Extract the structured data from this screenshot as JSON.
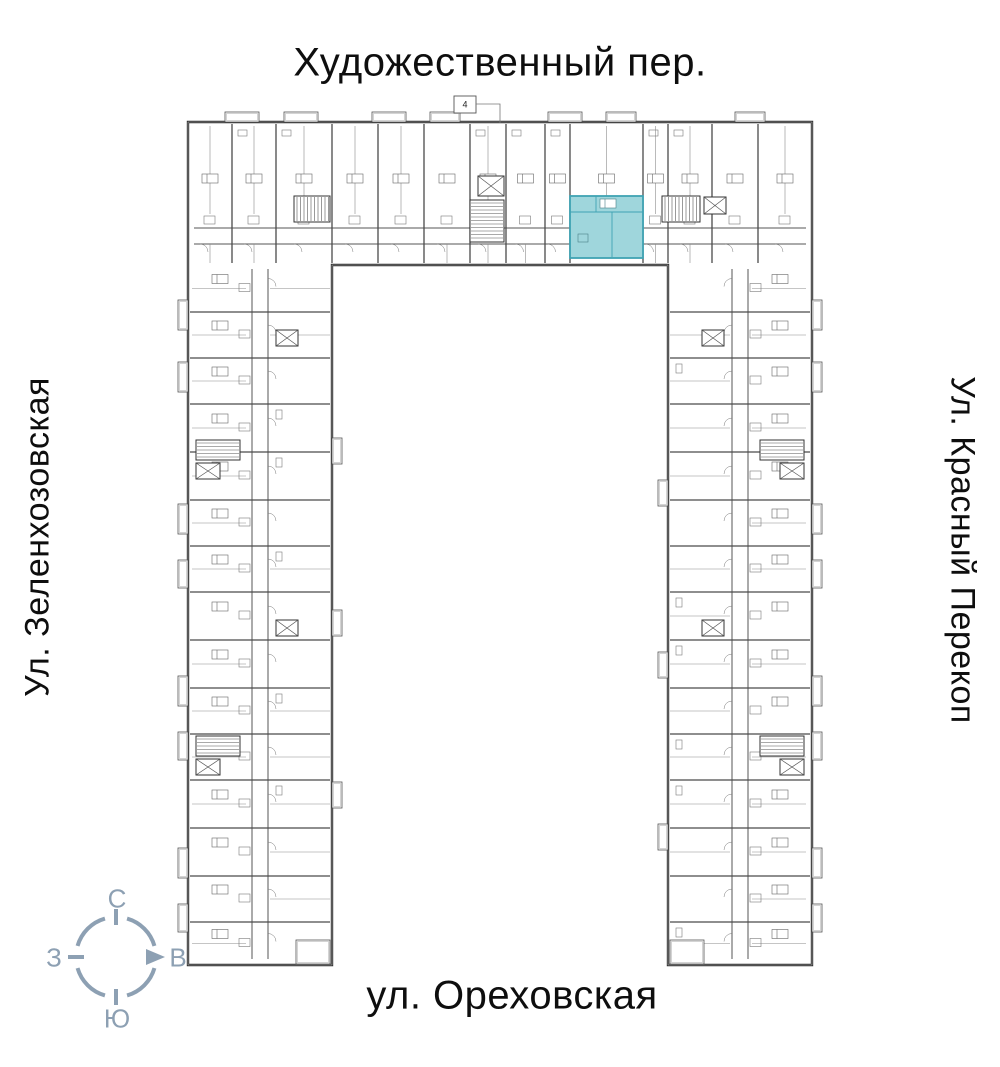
{
  "streets": {
    "top": "Художественный пер.",
    "bottom": "ул. Ореховская",
    "left": "Ул. Зеленхозовская",
    "right": "Ул. Красный Перекоп"
  },
  "compass": {
    "n": "С",
    "s": "Ю",
    "w": "З",
    "e": "В",
    "color": "#8da0b3",
    "center_x": 116,
    "center_y": 957,
    "radius": 40
  },
  "entrance_marker": "4",
  "highlight": {
    "fill": "#9fd6dc",
    "stroke": "#3fa3b3",
    "x": 570,
    "y": 196,
    "w": 73,
    "h": 62
  },
  "plan": {
    "wall_color": "#2c2c2c",
    "partition_color": "#4a4a4a",
    "minor_color": "#8c8c8c",
    "fixture_color": "#7a7a7a",
    "outline": "M 188,122 H 812 V 965 H 668 V 265 H 332 V 965 H 188 Z",
    "wings": [
      {
        "name": "top",
        "dir": "h",
        "x1": 188,
        "y1": 122,
        "x2": 812,
        "y2": 265,
        "corridor": [
          228,
          244
        ],
        "partitions": [
          232,
          276,
          332,
          378,
          424,
          470,
          506,
          545,
          570,
          643,
          668,
          712,
          758
        ]
      },
      {
        "name": "left",
        "dir": "v",
        "x1": 188,
        "y1": 265,
        "x2": 332,
        "y2": 965,
        "corridor": [
          252,
          268
        ],
        "partitions": [
          312,
          358,
          404,
          452,
          500,
          546,
          592,
          640,
          688,
          734,
          780,
          828,
          876,
          922
        ]
      },
      {
        "name": "right",
        "dir": "v",
        "x1": 668,
        "y1": 265,
        "x2": 812,
        "y2": 965,
        "corridor": [
          732,
          748
        ],
        "partitions": [
          312,
          358,
          404,
          452,
          500,
          546,
          592,
          640,
          688,
          734,
          780,
          828,
          876,
          922
        ]
      }
    ],
    "cores": [
      {
        "t": "stair",
        "x": 294,
        "y": 196,
        "w": 36,
        "h": 26,
        "dir": "h"
      },
      {
        "t": "elev",
        "x": 478,
        "y": 176,
        "w": 26,
        "h": 20
      },
      {
        "t": "stair",
        "x": 470,
        "y": 200,
        "w": 34,
        "h": 42,
        "dir": "v"
      },
      {
        "t": "stair",
        "x": 662,
        "y": 196,
        "w": 38,
        "h": 26,
        "dir": "h"
      },
      {
        "t": "elev",
        "x": 704,
        "y": 197,
        "w": 22,
        "h": 17
      },
      {
        "t": "stair",
        "x": 196,
        "y": 440,
        "w": 44,
        "h": 20,
        "dir": "v"
      },
      {
        "t": "elev",
        "x": 196,
        "y": 463,
        "w": 24,
        "h": 16
      },
      {
        "t": "stair",
        "x": 196,
        "y": 736,
        "w": 44,
        "h": 20,
        "dir": "v"
      },
      {
        "t": "elev",
        "x": 196,
        "y": 759,
        "w": 24,
        "h": 16
      },
      {
        "t": "elev",
        "x": 276,
        "y": 330,
        "w": 22,
        "h": 16
      },
      {
        "t": "elev",
        "x": 276,
        "y": 620,
        "w": 22,
        "h": 16
      },
      {
        "t": "stair",
        "x": 760,
        "y": 440,
        "w": 44,
        "h": 20,
        "dir": "v"
      },
      {
        "t": "elev",
        "x": 780,
        "y": 463,
        "w": 24,
        "h": 16
      },
      {
        "t": "stair",
        "x": 760,
        "y": 736,
        "w": 44,
        "h": 20,
        "dir": "v"
      },
      {
        "t": "elev",
        "x": 780,
        "y": 759,
        "w": 24,
        "h": 16
      },
      {
        "t": "elev",
        "x": 702,
        "y": 330,
        "w": 22,
        "h": 16
      },
      {
        "t": "elev",
        "x": 702,
        "y": 620,
        "w": 22,
        "h": 16
      }
    ],
    "balconies": [
      {
        "x": 225,
        "y": 112,
        "w": 34,
        "h": 10
      },
      {
        "x": 284,
        "y": 112,
        "w": 34,
        "h": 10
      },
      {
        "x": 372,
        "y": 112,
        "w": 34,
        "h": 10
      },
      {
        "x": 430,
        "y": 112,
        "w": 30,
        "h": 10
      },
      {
        "x": 548,
        "y": 112,
        "w": 34,
        "h": 10
      },
      {
        "x": 606,
        "y": 112,
        "w": 30,
        "h": 10
      },
      {
        "x": 735,
        "y": 112,
        "w": 30,
        "h": 10
      },
      {
        "x": 178,
        "y": 300,
        "w": 10,
        "h": 30
      },
      {
        "x": 178,
        "y": 362,
        "w": 10,
        "h": 30
      },
      {
        "x": 178,
        "y": 504,
        "w": 10,
        "h": 30
      },
      {
        "x": 178,
        "y": 560,
        "w": 10,
        "h": 28
      },
      {
        "x": 178,
        "y": 676,
        "w": 10,
        "h": 30
      },
      {
        "x": 178,
        "y": 732,
        "w": 10,
        "h": 28
      },
      {
        "x": 178,
        "y": 848,
        "w": 10,
        "h": 30
      },
      {
        "x": 178,
        "y": 904,
        "w": 10,
        "h": 28
      },
      {
        "x": 332,
        "y": 438,
        "w": 10,
        "h": 26
      },
      {
        "x": 332,
        "y": 610,
        "w": 10,
        "h": 26
      },
      {
        "x": 332,
        "y": 782,
        "w": 10,
        "h": 26
      },
      {
        "x": 296,
        "y": 940,
        "w": 34,
        "h": 24
      },
      {
        "x": 812,
        "y": 300,
        "w": 10,
        "h": 30
      },
      {
        "x": 812,
        "y": 362,
        "w": 10,
        "h": 30
      },
      {
        "x": 812,
        "y": 504,
        "w": 10,
        "h": 30
      },
      {
        "x": 812,
        "y": 560,
        "w": 10,
        "h": 28
      },
      {
        "x": 812,
        "y": 676,
        "w": 10,
        "h": 30
      },
      {
        "x": 812,
        "y": 732,
        "w": 10,
        "h": 28
      },
      {
        "x": 812,
        "y": 848,
        "w": 10,
        "h": 30
      },
      {
        "x": 812,
        "y": 904,
        "w": 10,
        "h": 28
      },
      {
        "x": 658,
        "y": 480,
        "w": 10,
        "h": 26
      },
      {
        "x": 658,
        "y": 652,
        "w": 10,
        "h": 26
      },
      {
        "x": 658,
        "y": 824,
        "w": 10,
        "h": 26
      },
      {
        "x": 670,
        "y": 940,
        "w": 34,
        "h": 24
      }
    ],
    "entrance_box": {
      "x": 454,
      "y": 96,
      "w": 22,
      "h": 17,
      "leader": [
        [
          476,
          104
        ],
        [
          500,
          104
        ],
        [
          500,
          123
        ]
      ]
    }
  }
}
